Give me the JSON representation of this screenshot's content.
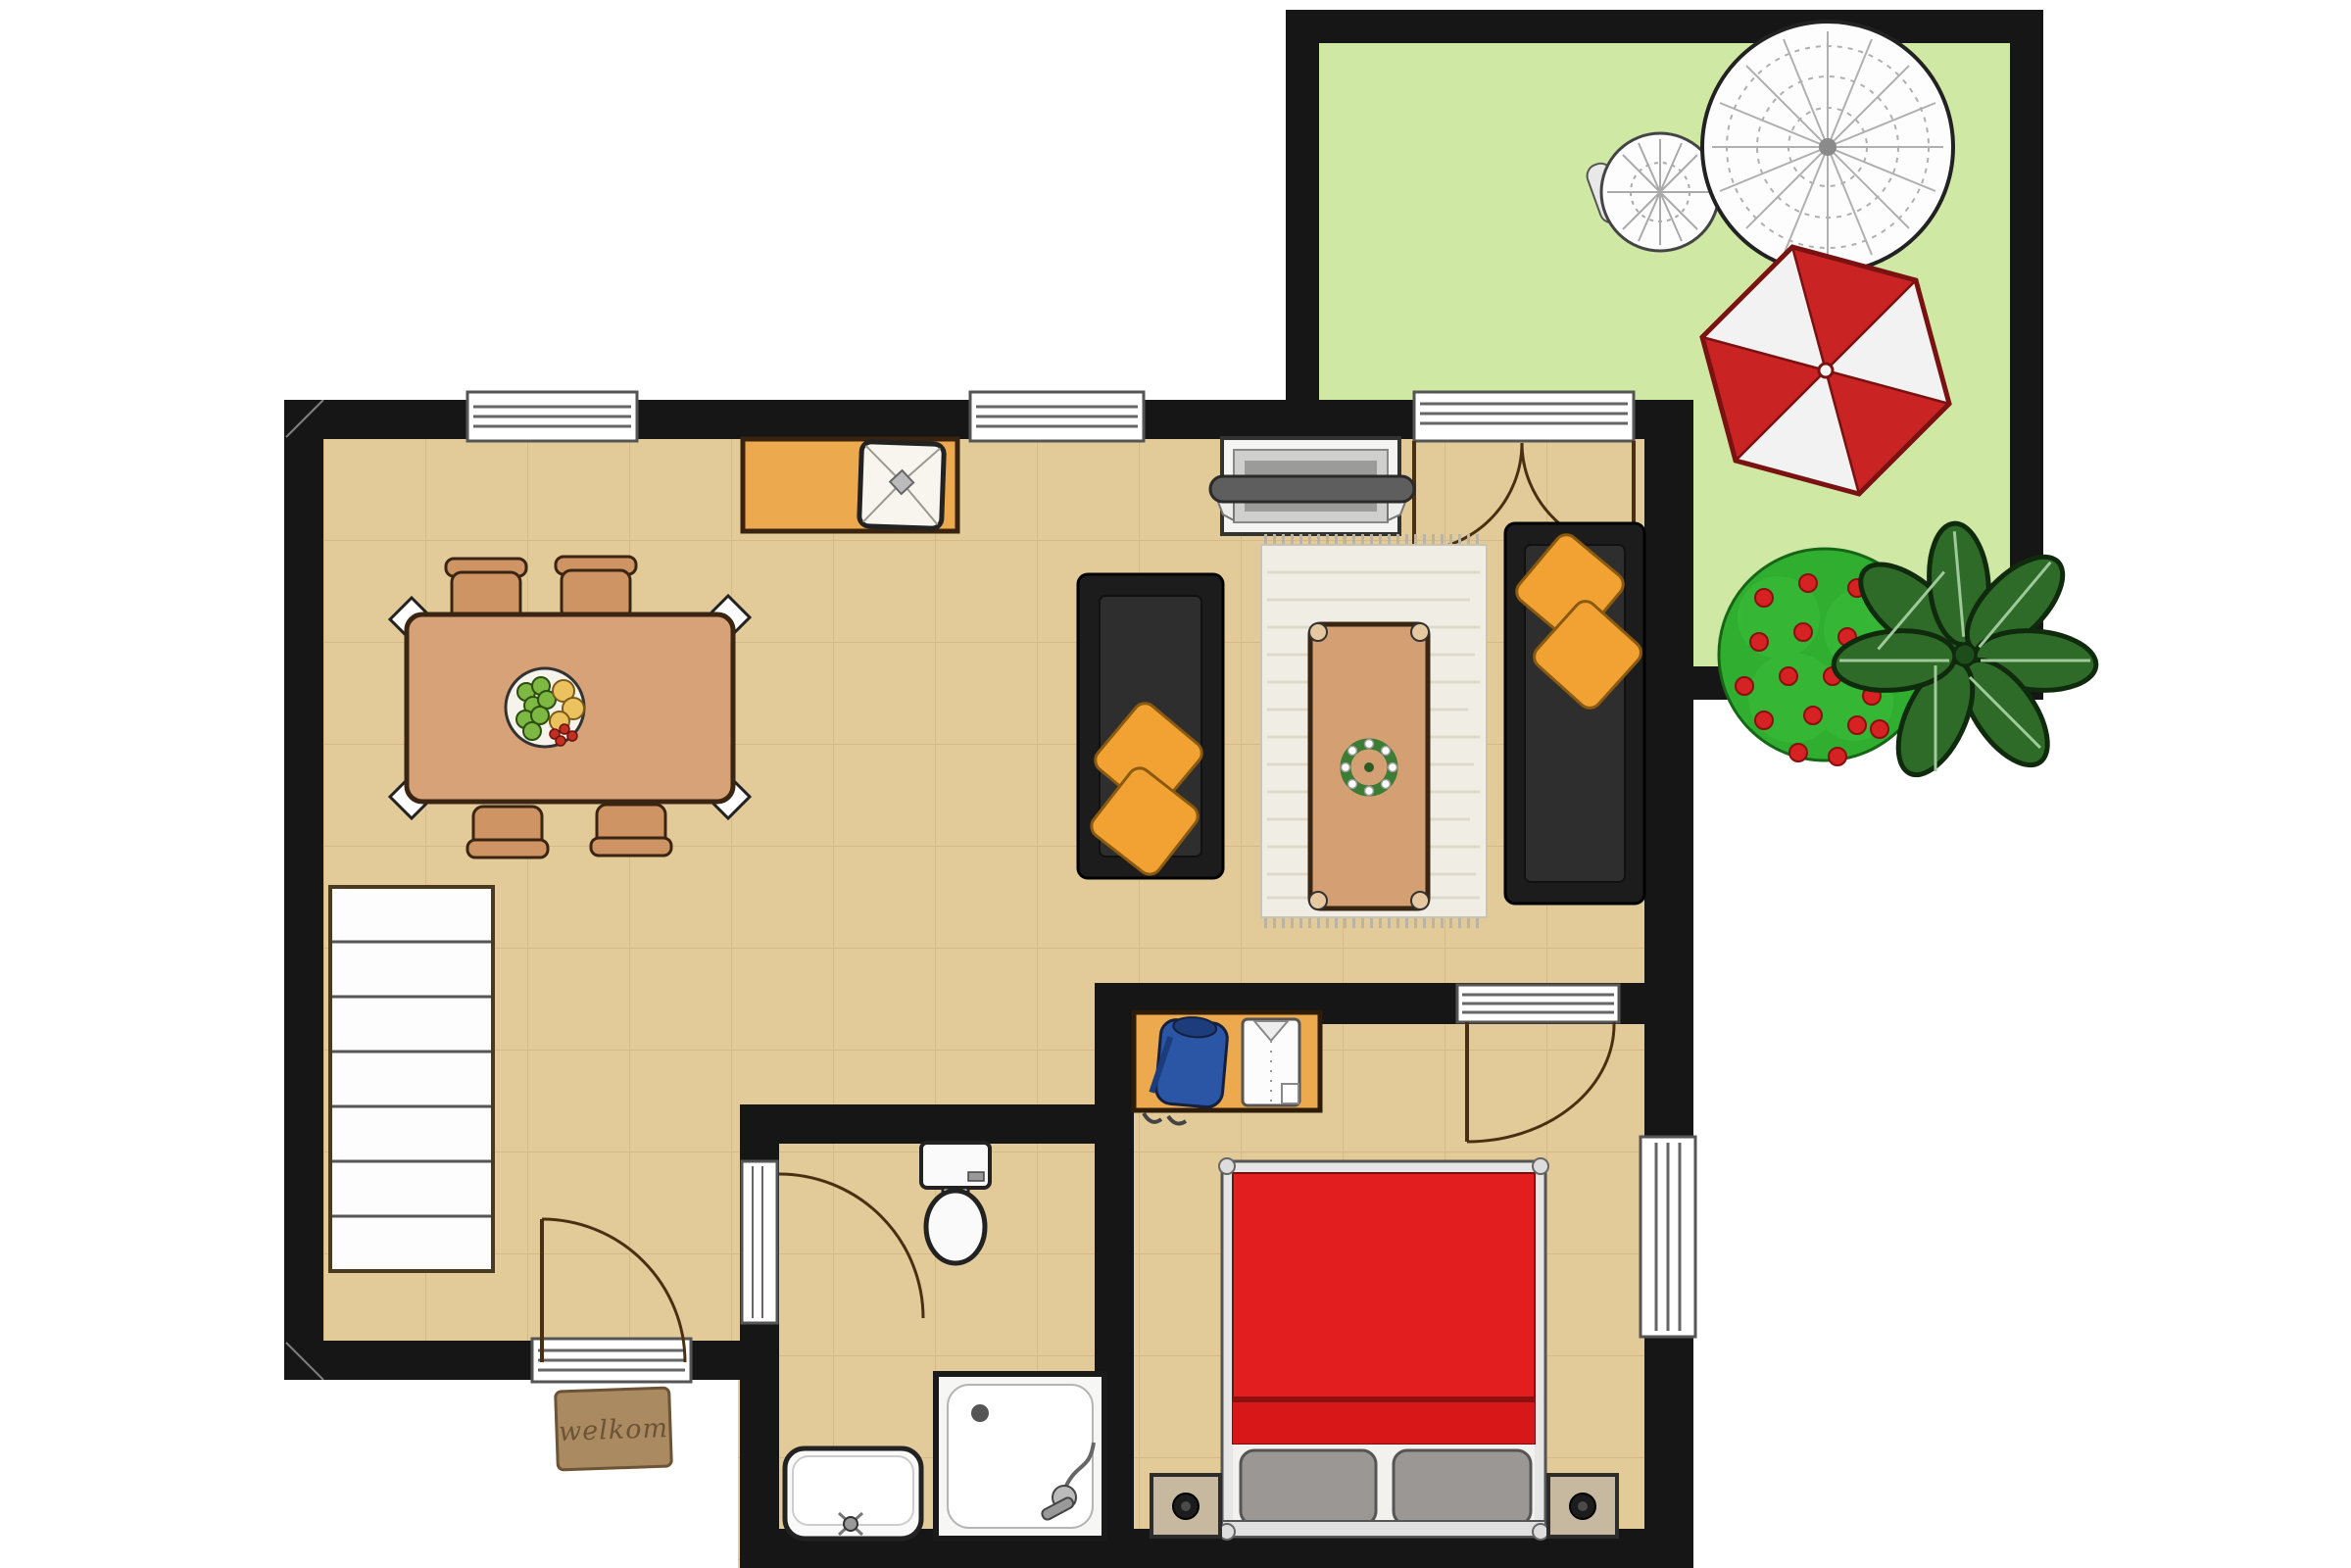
{
  "plan": {
    "type": "apartment-floor-plan-top-view",
    "mat_text": "welkom",
    "inventory": {
      "dining_chairs": 4,
      "dining_table": 1,
      "fruit_bowl": 1,
      "sideboard_with_lamp": 1,
      "tv_cabinet": 1,
      "sofas": 2,
      "throw_pillows": 4,
      "area_rug": 1,
      "coffee_table": 1,
      "staircase_steps": 7,
      "toilet": 1,
      "shower": 1,
      "washbasin": 1,
      "wardrobe": 1,
      "double_bed": 1,
      "nightstands": 2,
      "garden_table": 1,
      "garden_chair": 1,
      "parasol": 1,
      "flower_bush": 1,
      "potted_plant": 1,
      "windows": 3,
      "doors": 5
    }
  },
  "palette": {
    "wall": "#161616",
    "floor": "#e2cb98",
    "floor_line": "#c6aa78",
    "garden_grass": "#cfe9a5",
    "outline_wood": "#3a2512",
    "wood_table": "#d7a277",
    "wood_chair": "#cf9464",
    "sideboard_orange": "#eda94e",
    "sofa_black": "#1c1c1c",
    "pillow_orange": "#f2a233",
    "rug_cream": "#f0ede4",
    "coffee_table_wood": "#d4a073",
    "bed_red": "#e31e1e",
    "bed_frame_silver": "#e6e6e6",
    "bed_pillow_gray": "#9a9794",
    "nightstand_tan": "#c7b9a0",
    "sweater_blue": "#2b55a5",
    "shirt_white": "#fcfcfc",
    "mat_brown": "#aa8a60",
    "mat_text": "#6d5335",
    "parasol_red": "#c92323",
    "parasol_white": "#f2f2f2",
    "lace_white": "#fdfdfd",
    "bush_green": "#2fae2f",
    "flower_red": "#d62222",
    "plant_green": "#2e6b28",
    "fixture_white": "#fafafa",
    "stairs_white": "#fdfdfd",
    "window_white": "#ffffff"
  }
}
